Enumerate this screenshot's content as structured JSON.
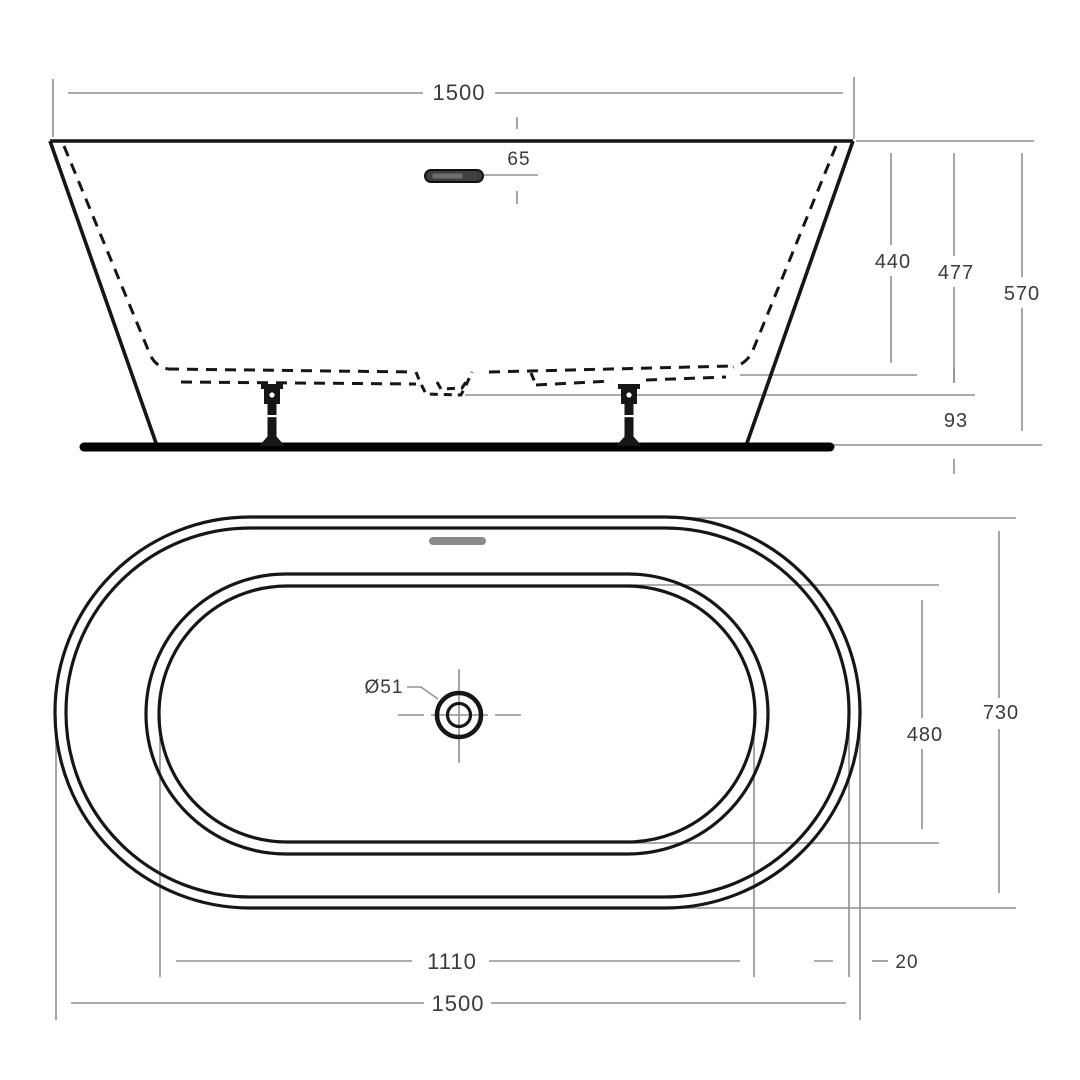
{
  "side_view": {
    "overall_length": "1500",
    "overflow_height": "65",
    "inner_depth": "440",
    "depth_to_shell": "477",
    "overall_height": "570",
    "underside_clearance": "93"
  },
  "plan_view": {
    "drain_diameter": "Ø51",
    "inner_width": "480",
    "overall_width": "730",
    "inner_length": "1110",
    "wall_thickness": "20",
    "overall_length": "1500"
  },
  "colors": {
    "outline": "#161616",
    "dimension_line": "#909090",
    "label_text": "#3a3a3a",
    "background": "#ffffff",
    "overflow_fill": "#3f3f3f",
    "plan_overflow_fill": "#8a8a8a"
  }
}
